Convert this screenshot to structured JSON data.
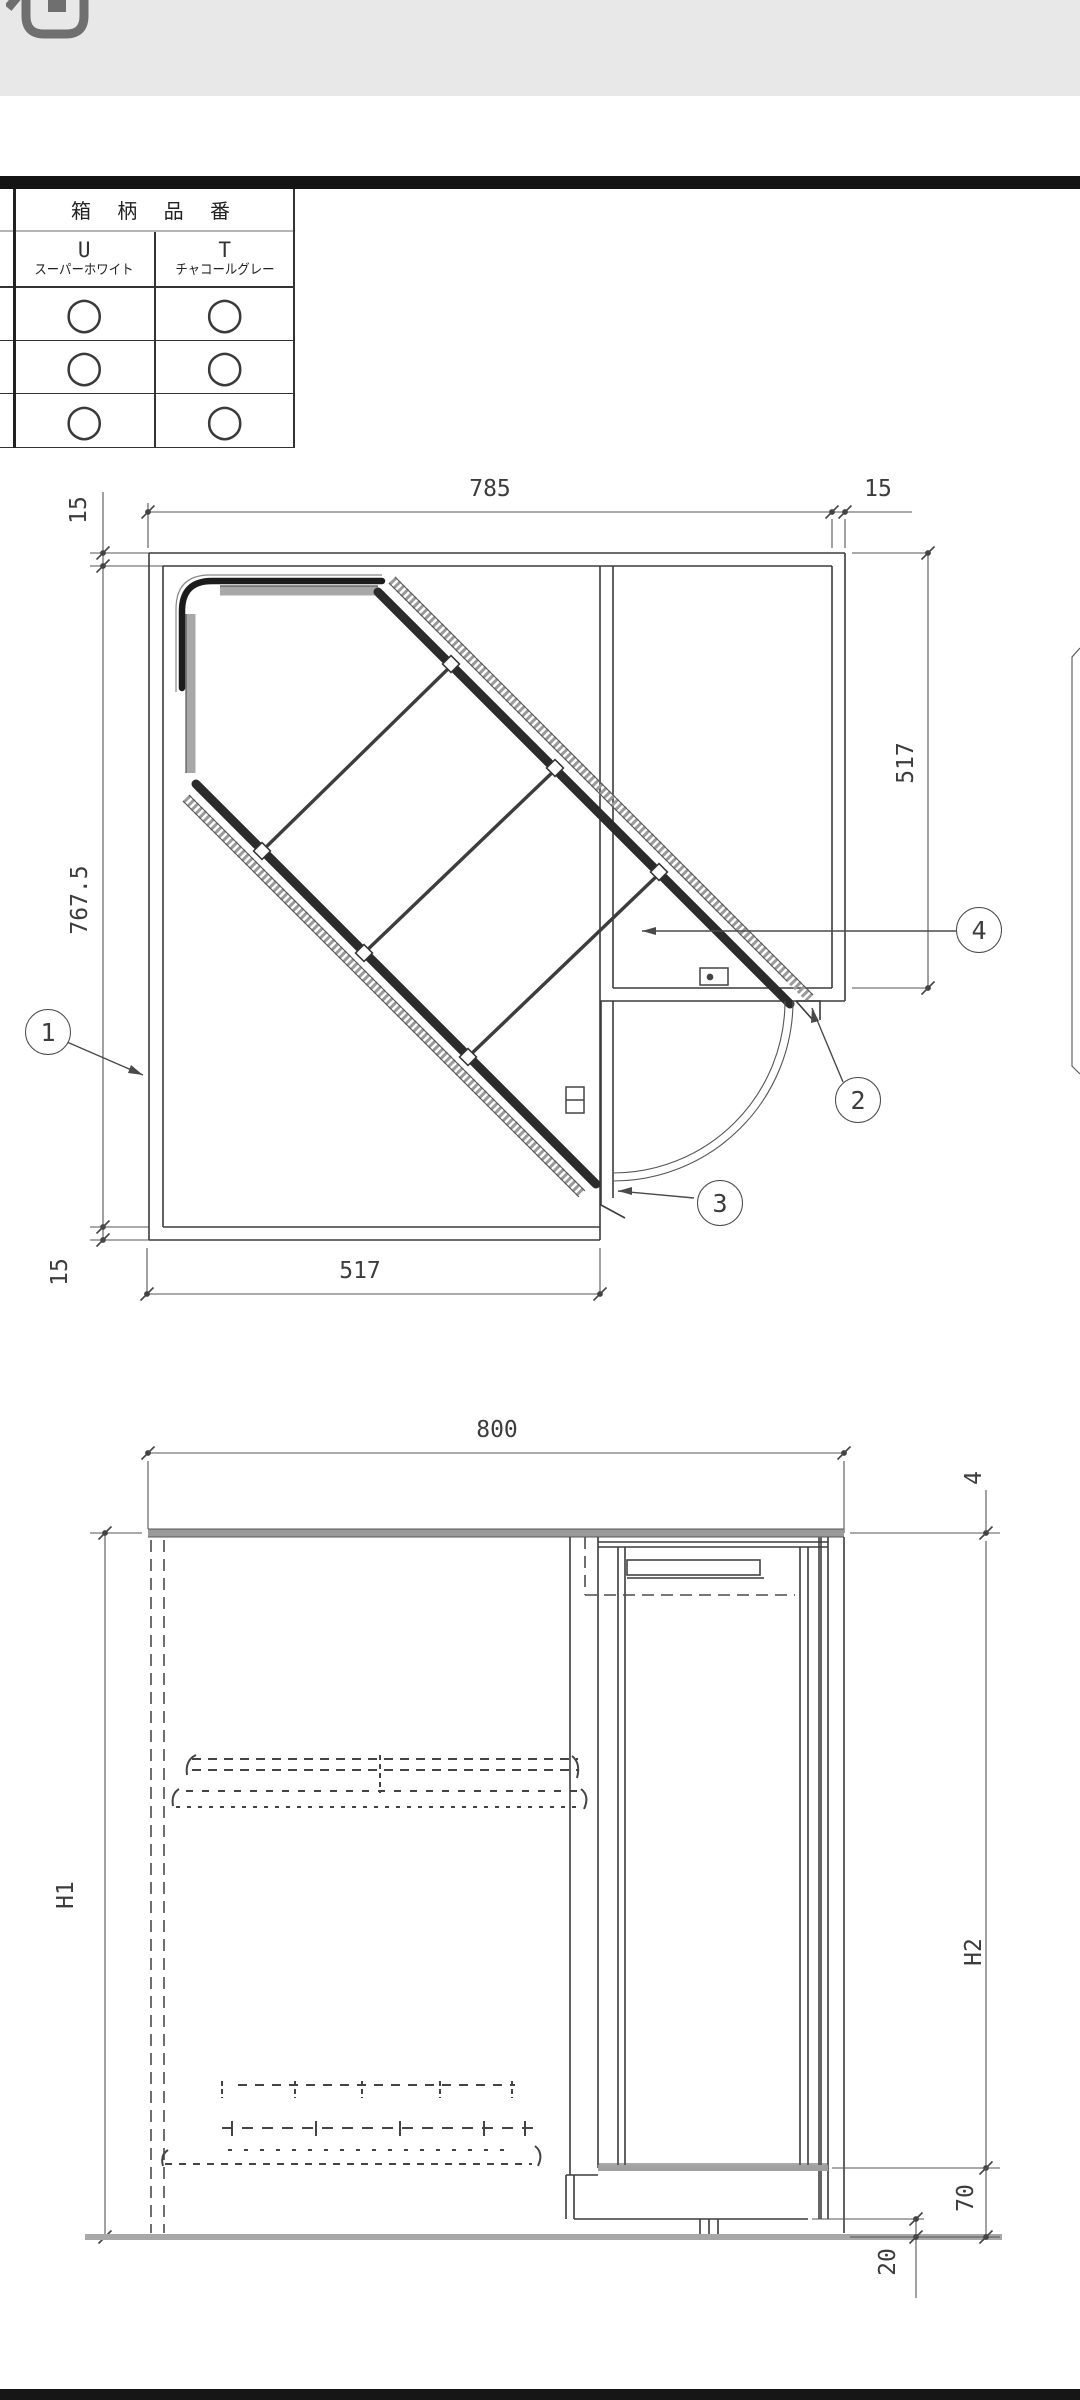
{
  "parts_table": {
    "title": "箱 柄 品 番",
    "columns": [
      {
        "code": "U",
        "name": "スーパーホワイト"
      },
      {
        "code": "T",
        "name": "チャコールグレー"
      }
    ],
    "rows": [
      [
        "○",
        "○"
      ],
      [
        "○",
        "○"
      ],
      [
        "○",
        "○"
      ]
    ]
  },
  "plan_view": {
    "dims": {
      "width_main": "785",
      "wall_right": "15",
      "wall_top_left": "15",
      "depth_left": "767.5",
      "wall_bottom_left": "15",
      "width_bottom": "517",
      "depth_right": "517"
    },
    "callouts": [
      "1",
      "2",
      "3",
      "4"
    ]
  },
  "front_view": {
    "dims": {
      "width": "800",
      "top_panel": "4",
      "height_left": "H1",
      "height_right": "H2",
      "base_height": "70",
      "foot_height": "20"
    }
  }
}
